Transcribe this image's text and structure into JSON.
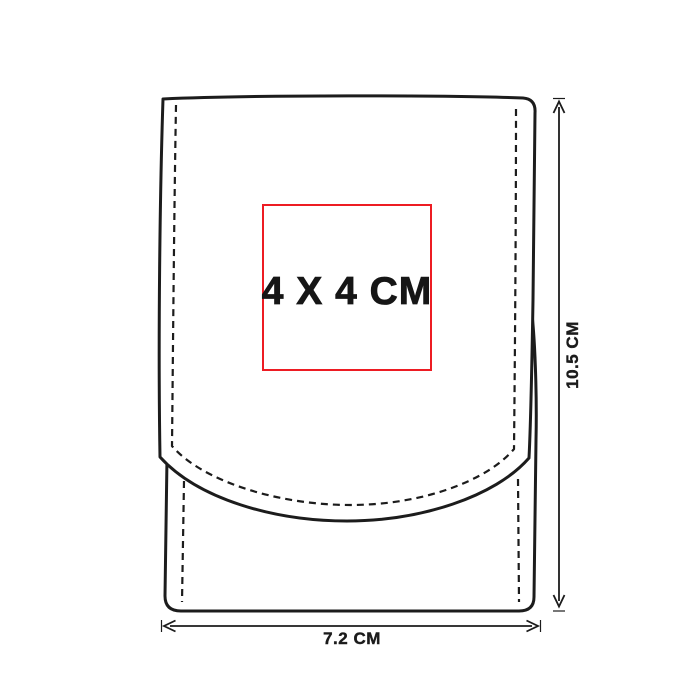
{
  "colors": {
    "accent-red": "#ed1c23",
    "line-black": "#1c1c1c",
    "bg-white": "#ffffff"
  },
  "print_area": {
    "label": "4 X 4 CM"
  },
  "dimensions": {
    "height": {
      "label": "10.5 CM"
    },
    "width": {
      "label": "7.2 CM"
    }
  }
}
